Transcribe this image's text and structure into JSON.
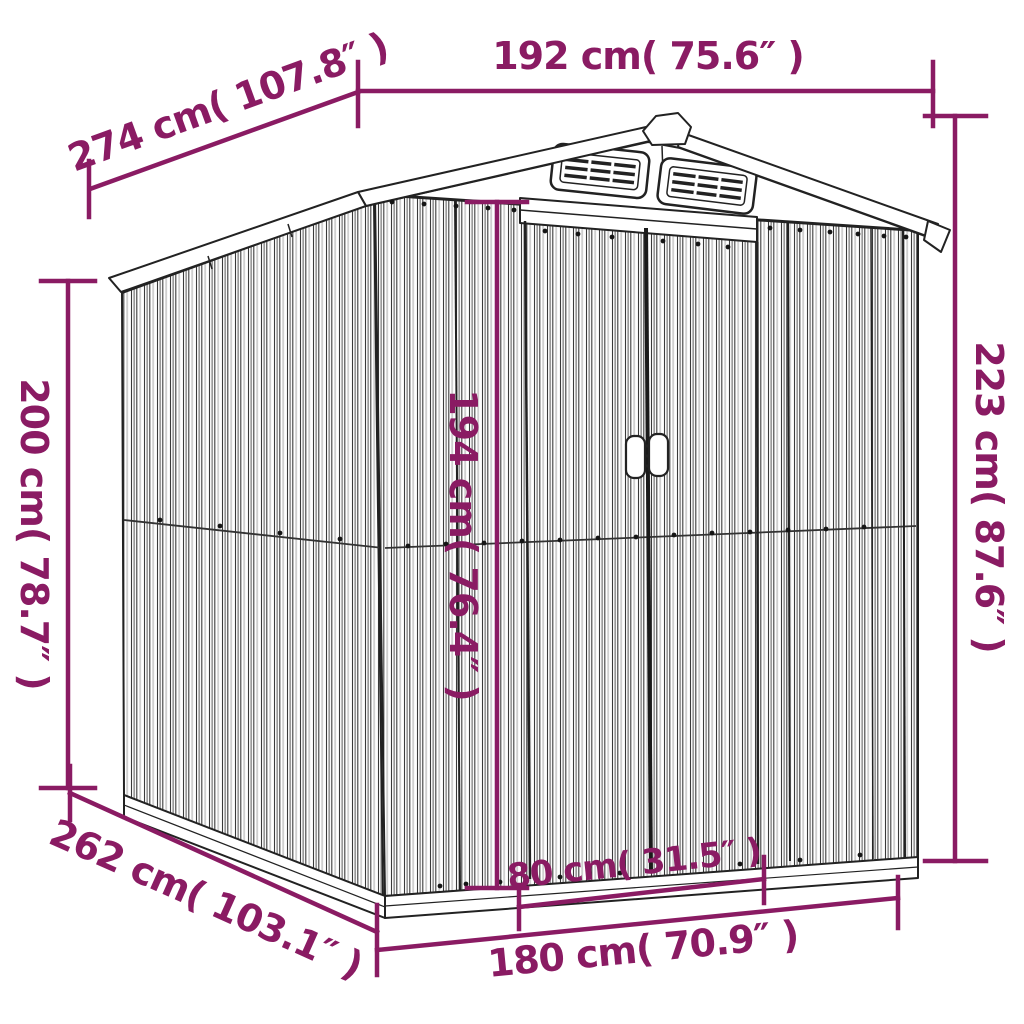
{
  "colors": {
    "dimension": "#8a1b63",
    "line_art": "#222222",
    "background": "#ffffff"
  },
  "diagram": {
    "subject": "garden-shed-dimension-diagram",
    "dimensions": {
      "roof_width_top": {
        "label": "192 cm( 75.6″ )"
      },
      "roof_depth": {
        "label": "274 cm( 107.8″ )"
      },
      "wall_height_rear": {
        "label": "200 cm( 78.7″ )"
      },
      "door_height": {
        "label": "194 cm( 76.4″ )"
      },
      "total_height": {
        "label": "223 cm( 87.6″ )"
      },
      "base_depth": {
        "label": "262 cm( 103.1″ )"
      },
      "door_width": {
        "label": "80 cm( 31.5″ )"
      },
      "base_width": {
        "label": "180 cm( 70.9″ )"
      }
    }
  }
}
